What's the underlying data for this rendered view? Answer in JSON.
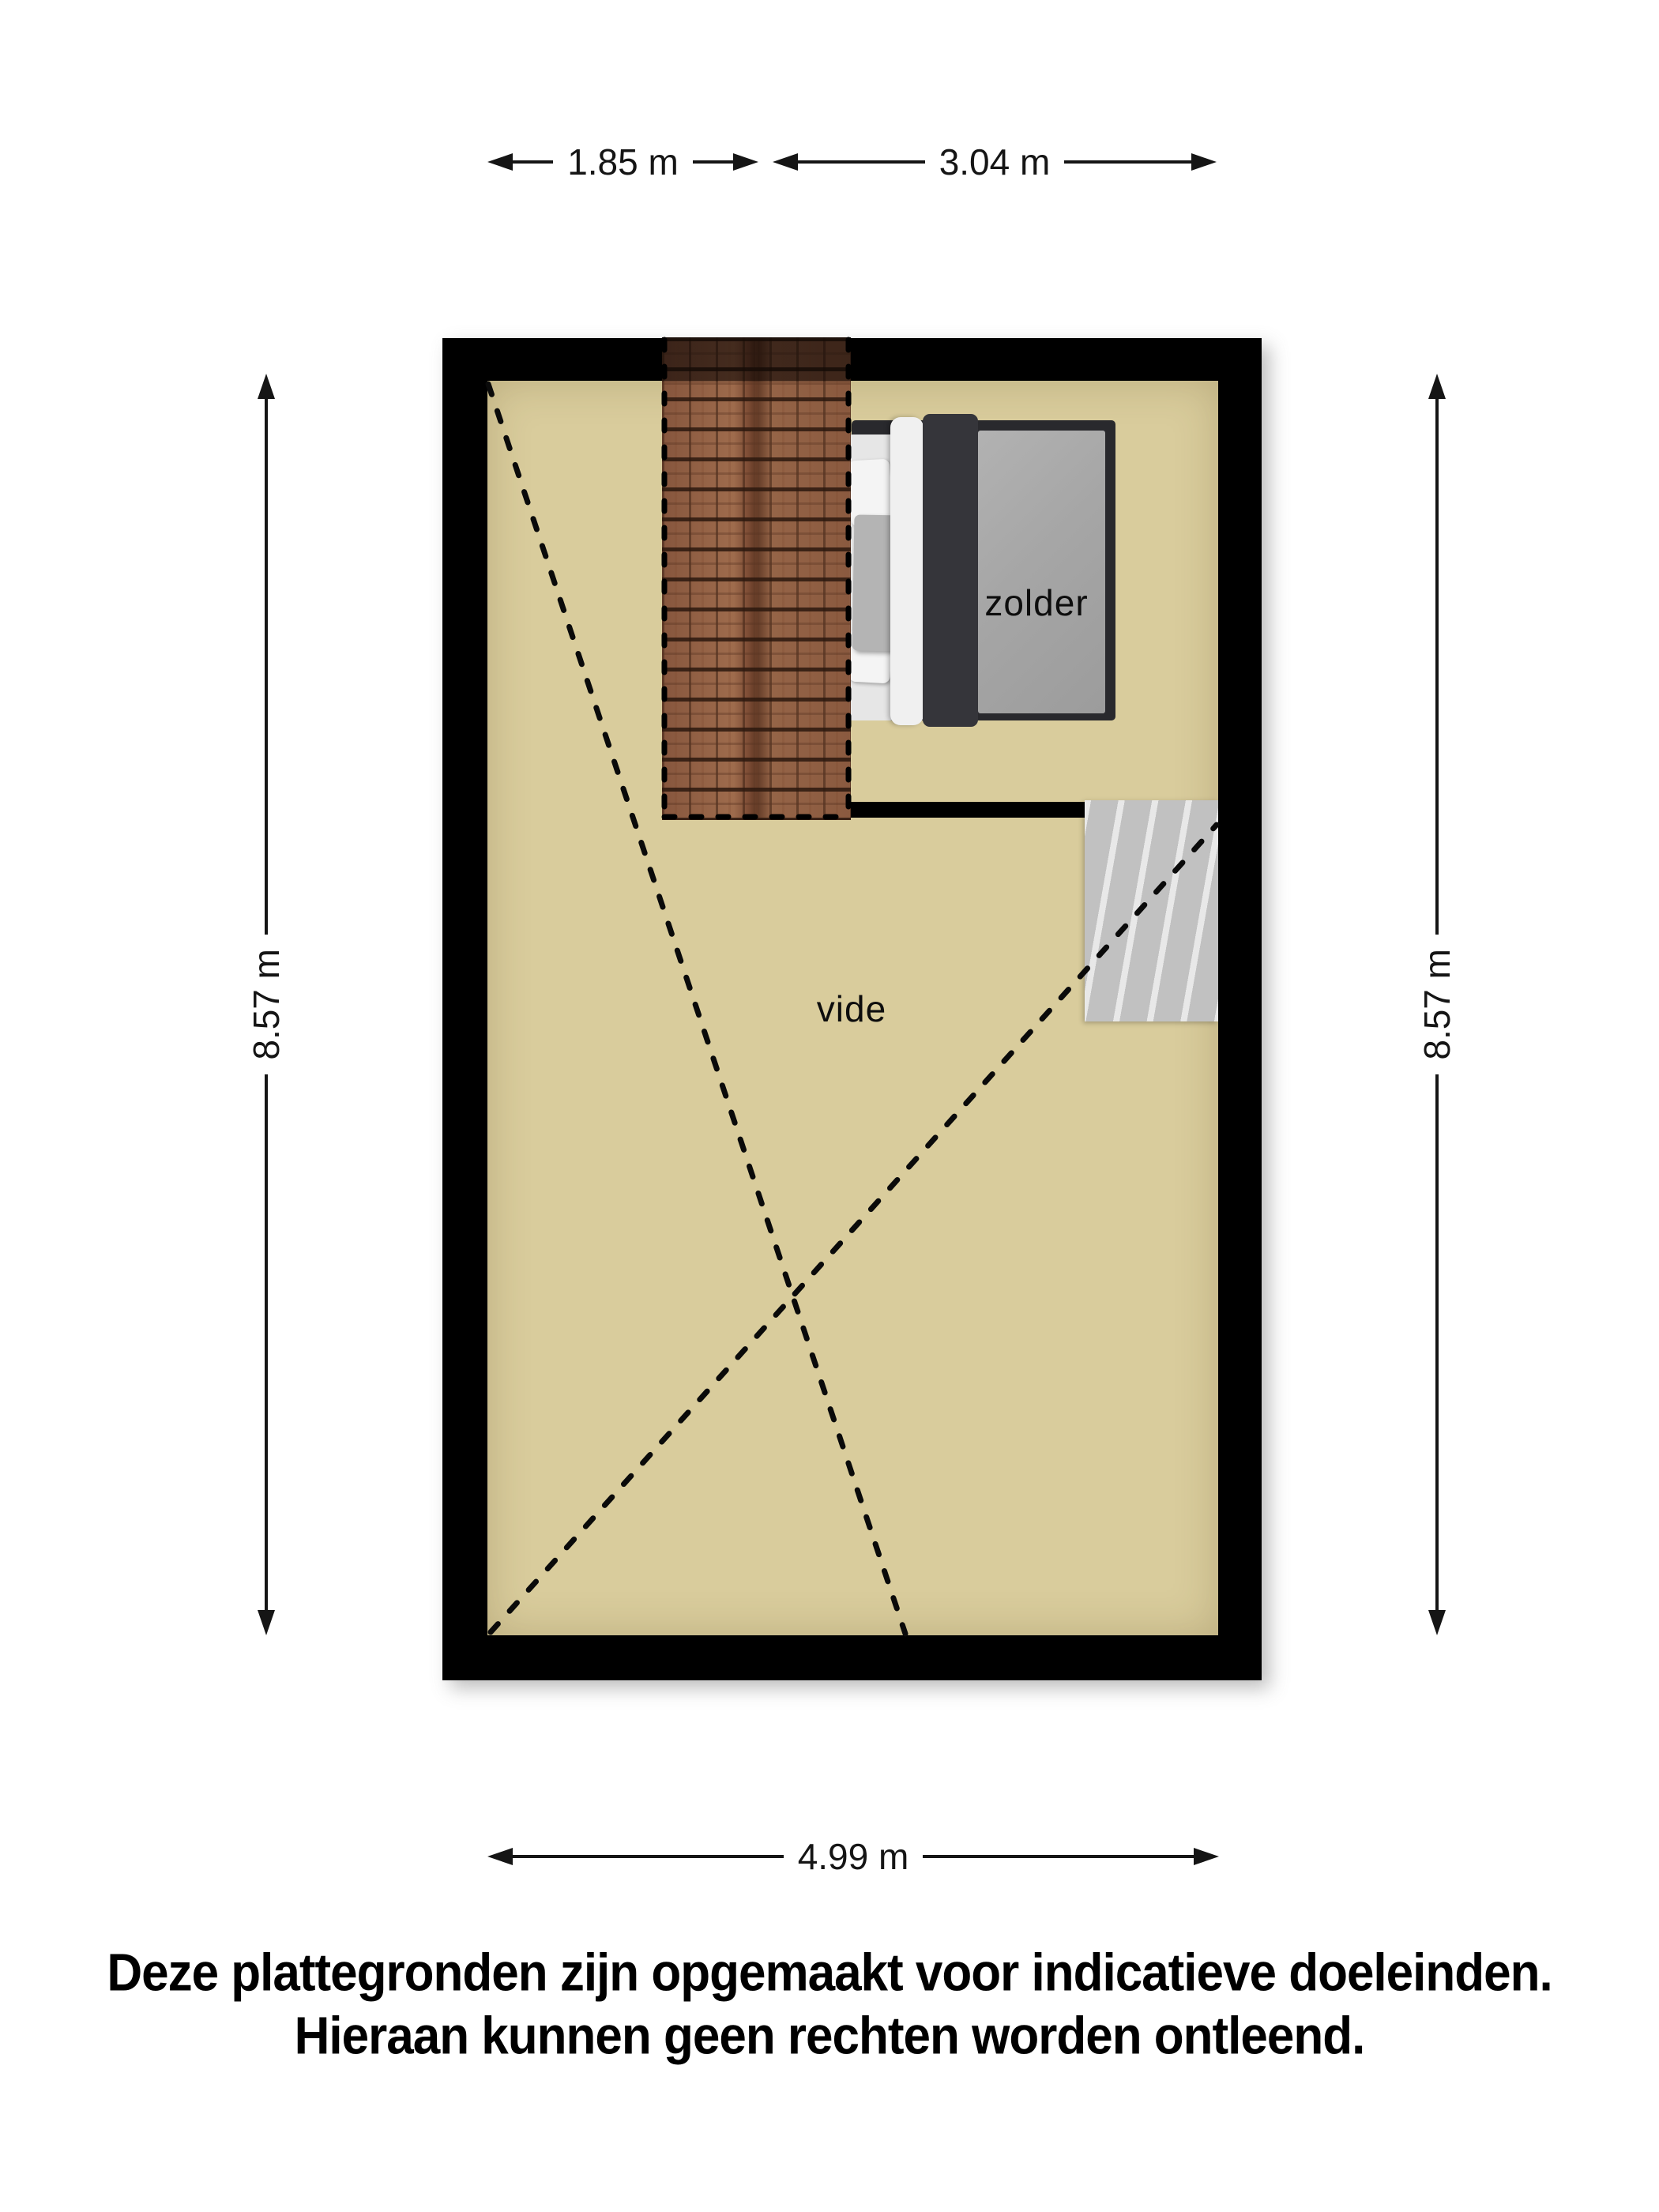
{
  "title": "floor-plan-attic",
  "dimensions": {
    "top_left": "1.85 m",
    "top_right": "3.04 m",
    "side_left": "8.57 m",
    "side_right": "8.57 m",
    "bottom": "4.99 m"
  },
  "rooms": {
    "attic": "zolder",
    "void": "vide"
  },
  "disclaimer": {
    "line1": "Deze plattegronden zijn opgemaakt voor indicatieve doeleinden.",
    "line2": "Hieraan kunnen geen rechten worden ontleend."
  },
  "colors": {
    "wall": "#000000",
    "floor": "#d9cc9c",
    "roof_tiles": "#8a5a42",
    "stairs": "#cdcdcd",
    "bed_frame": "#29292d",
    "bed_blanket": "#a6a6a6",
    "bed_duvet": "#35353a",
    "dimension_lines": "#151515"
  }
}
